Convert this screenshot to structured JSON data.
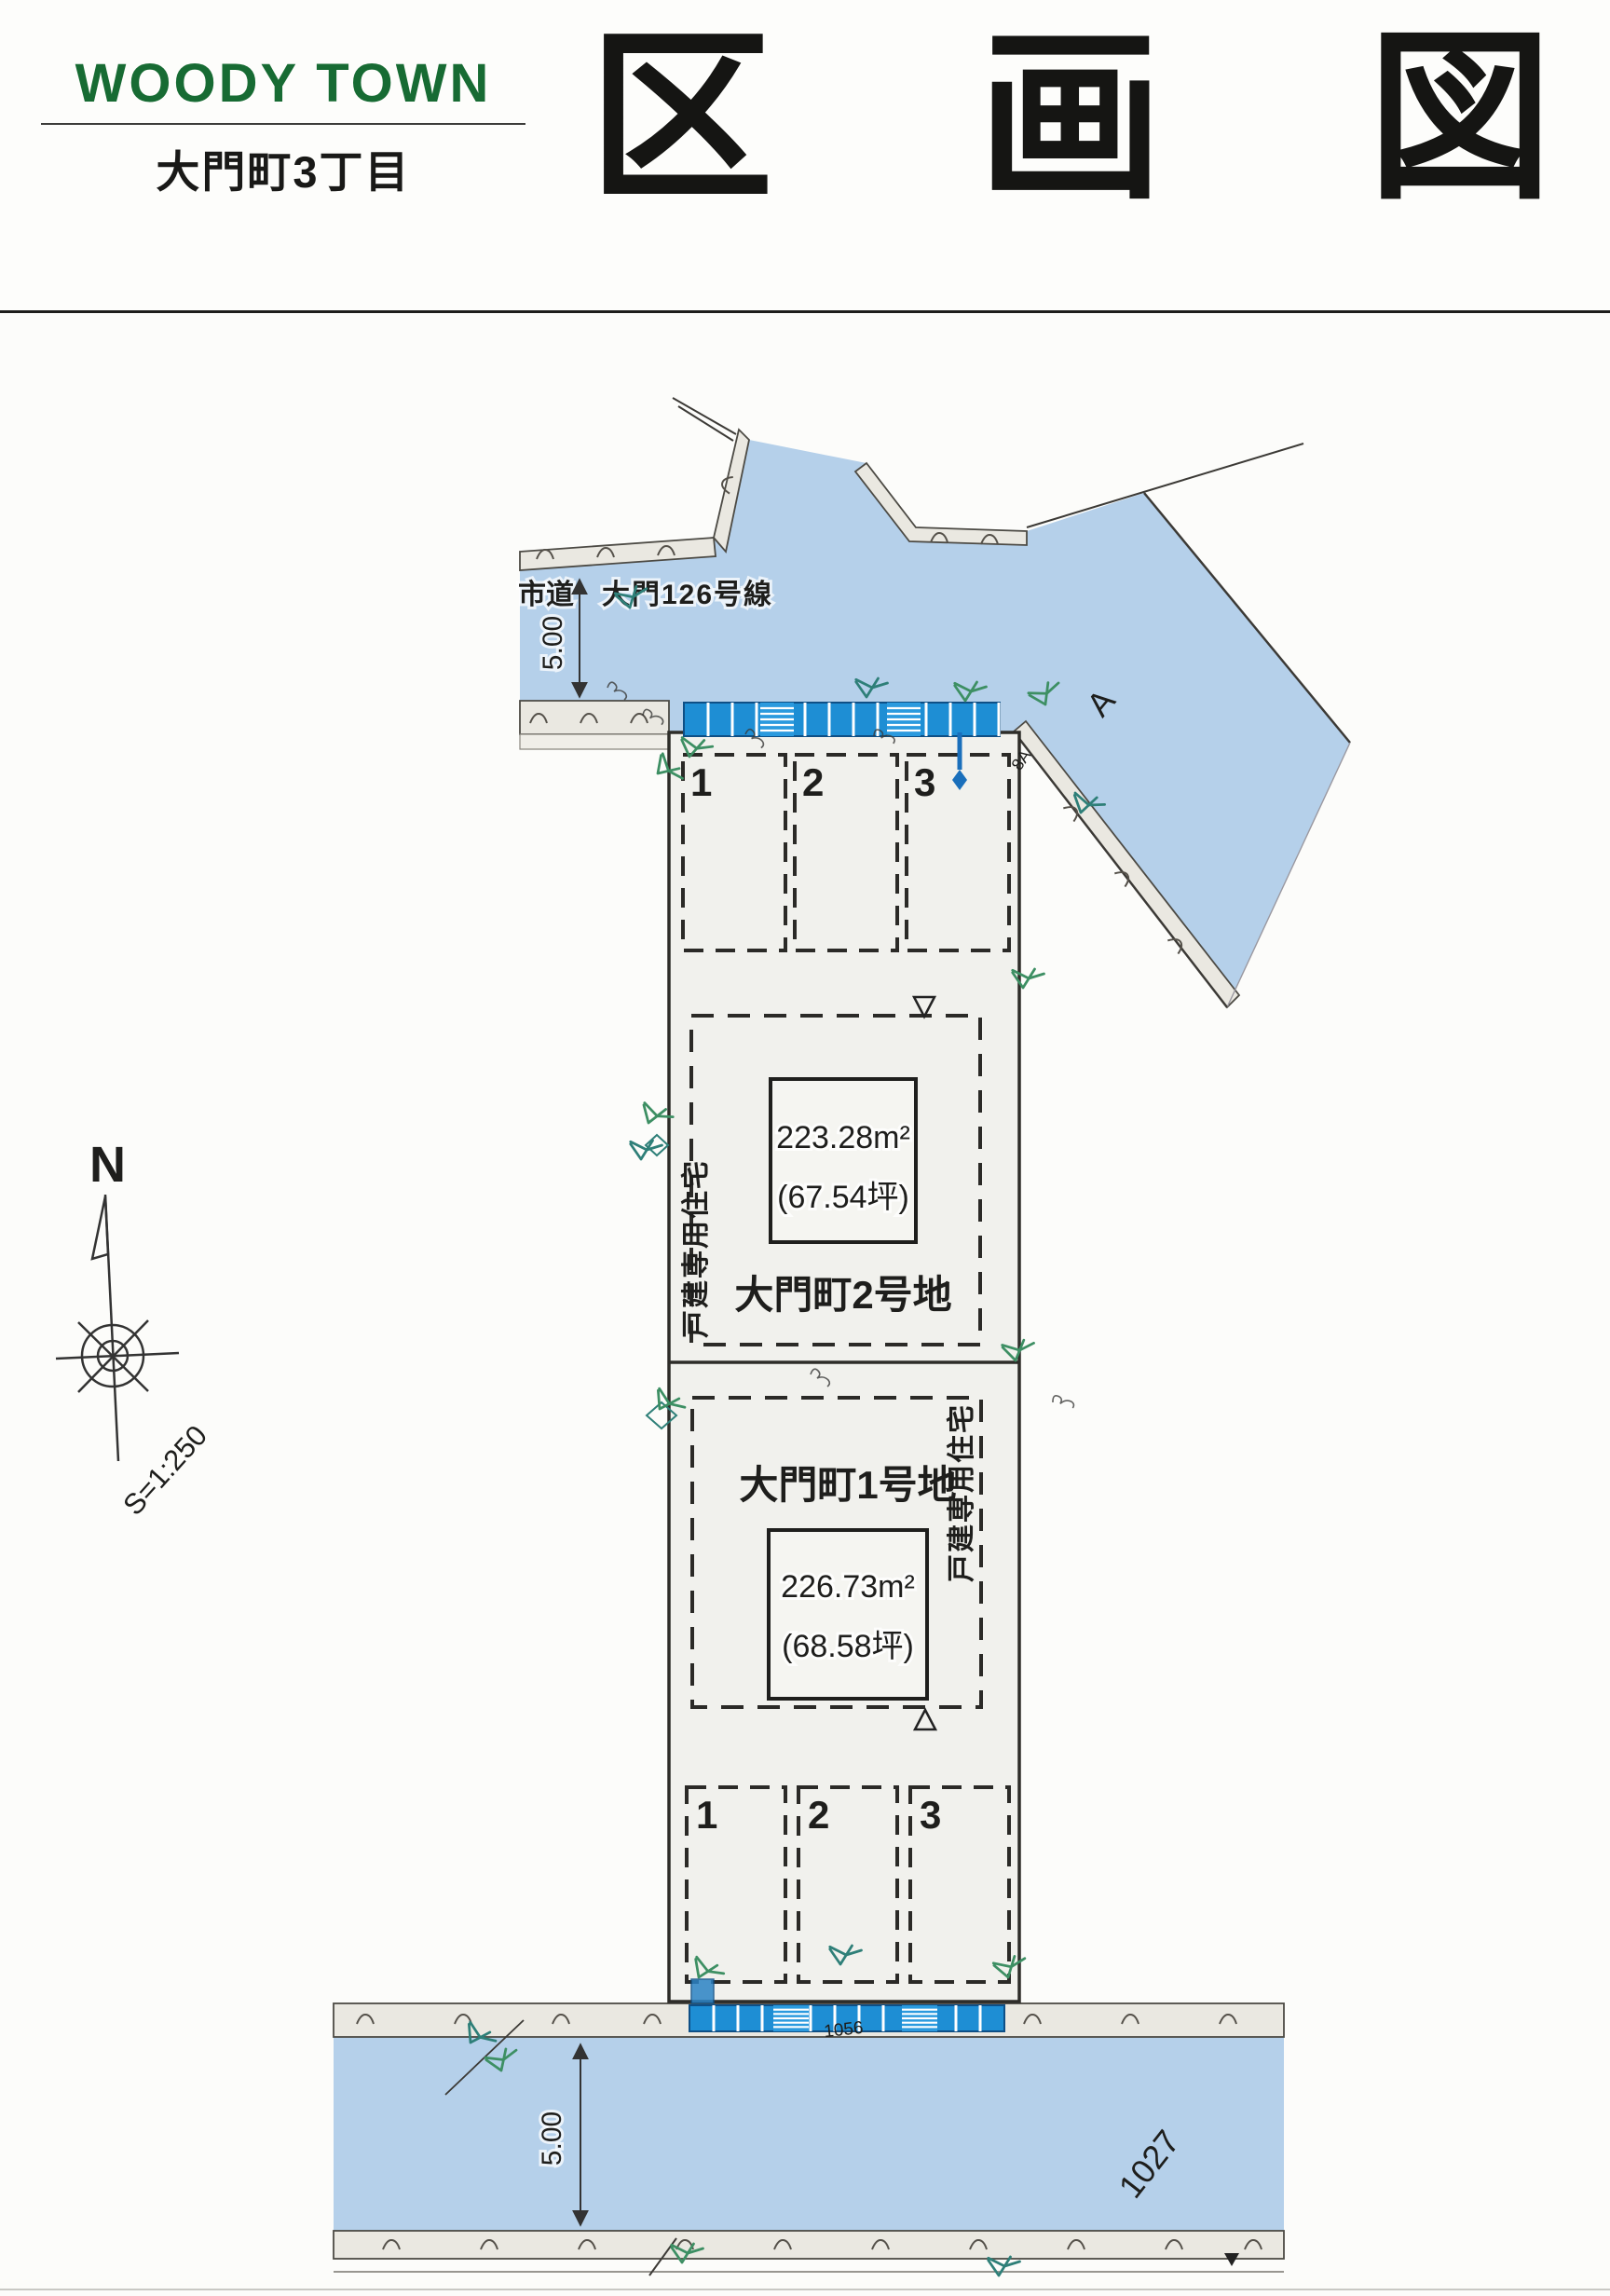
{
  "header": {
    "brand": "WOODY TOWN",
    "subtitle": "大門町3丁目",
    "title": "区画図",
    "title_chars": [
      "区",
      "画",
      "図"
    ]
  },
  "colors": {
    "brand_green": "#176b33",
    "road_blue": "#b5d0ea",
    "parking_block_blue": "#1e8ed4",
    "curb_gray": "#eae8e1",
    "lot_fill": "#f1f1ed",
    "line_dark": "#2e2d29",
    "vegetation_green": "#3d8f63"
  },
  "plan": {
    "road_top": {
      "name_prefix": "市道",
      "name": "大門126号線",
      "width_dim": "5.00"
    },
    "road_bottom": {
      "width_dim": "5.00",
      "road_number": "1027"
    },
    "north_label": "N",
    "scale_label": "S=1:250",
    "lot2": {
      "name": "大門町2号地",
      "area_m2": "223.28m²",
      "area_tsubo": "(67.54坪)",
      "use": "戸建専用住宅"
    },
    "lot1": {
      "name": "大門町1号地",
      "area_m2": "226.73m²",
      "area_tsubo": "(68.58坪)",
      "use": "戸建専用住宅"
    },
    "parking_top": {
      "spaces": [
        "1",
        "2",
        "3"
      ]
    },
    "parking_bottom": {
      "spaces": [
        "1",
        "2",
        "3"
      ]
    },
    "annotations": {
      "point_a": "A",
      "point_8a": "8A",
      "note_1056": "1056"
    }
  }
}
